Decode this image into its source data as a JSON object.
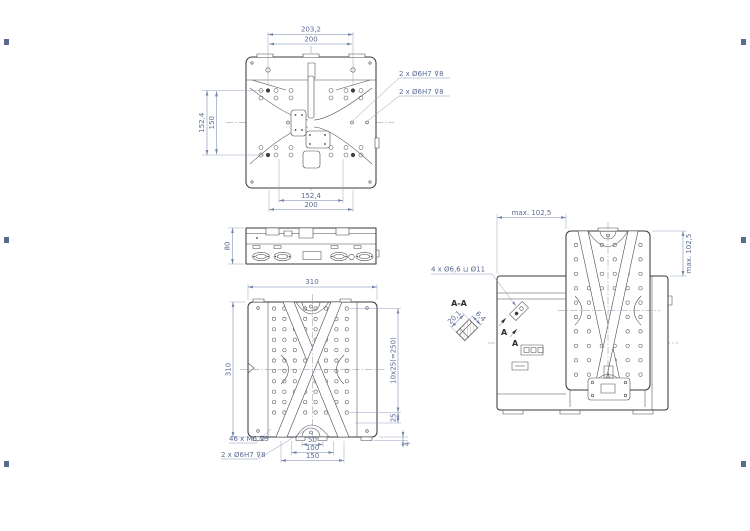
{
  "views": {
    "top": {
      "dim_w1": "203,2",
      "dim_w2": "200",
      "dim_h1": "152,4",
      "dim_h2": "150",
      "dim_b1": "152,4",
      "dim_b2": "200",
      "label_dowel_upper": "2 x Ø6H7 ⊽8",
      "label_dowel_lower": "2 x Ø6H7 ⊽8"
    },
    "side": {
      "dim_height": "80"
    },
    "bottom": {
      "dim_width": "310",
      "dim_height": "310",
      "dim_hole_pitch": "10x25(=250)",
      "dim_25": "25",
      "dim_pad": "4",
      "dim_50": "50",
      "dim_100": "100",
      "dim_150": "150",
      "label_m6": "46 x M6 ⊽9",
      "label_dowel": "2 x Ø6H7 ⊽8"
    },
    "displaced": {
      "dim_travel_h": "max. 102,5",
      "dim_travel_v": "max. 102,5",
      "label_cbore": "4 x Ø6,6 ⊔ Ø11",
      "marker_a1": "A",
      "marker_a2": "A"
    },
    "section": {
      "title": "A-A",
      "dim_len": "20,1",
      "dim_dep": "6,4"
    }
  }
}
